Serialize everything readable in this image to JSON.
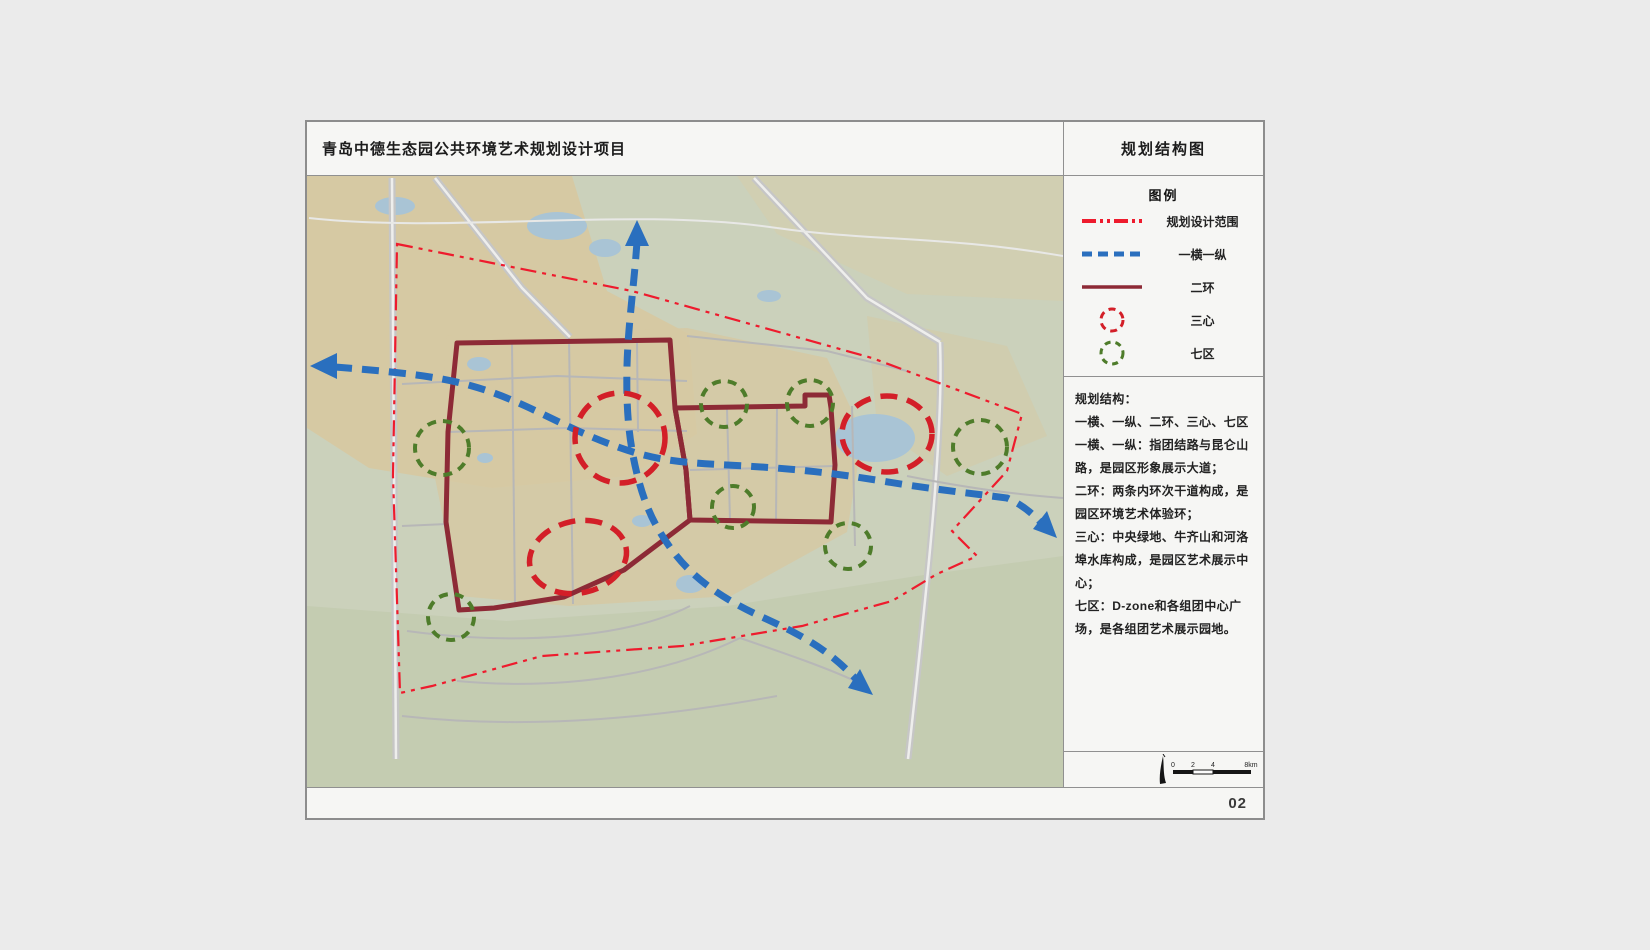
{
  "page": {
    "background": "#ebebeb",
    "page_number": "02"
  },
  "header": {
    "title": "青岛中德生态园公共环境艺术规划设计项目",
    "map_title": "规划结构图"
  },
  "legend": {
    "heading": "图例",
    "items": [
      {
        "label": "规划设计范围",
        "symbol": "red-dashdot-line",
        "color": "#ee1b2d"
      },
      {
        "label": "一横一纵",
        "symbol": "blue-dashed-line",
        "color": "#2a6fbe"
      },
      {
        "label": "二环",
        "symbol": "maroon-solid-line",
        "color": "#8d2a36"
      },
      {
        "label": "三心",
        "symbol": "red-dashed-circle",
        "color": "#d31f28"
      },
      {
        "label": "七区",
        "symbol": "green-dashed-circle",
        "color": "#4e7c2a"
      }
    ]
  },
  "description": {
    "lines": [
      "规划结构：",
      "一横、一纵、二环、三心、七区",
      "一横、一纵：指团结路与昆仑山路，是园区形象展示大道；",
      "二环：两条内环次干道构成，是园区环境艺术体验环；",
      "三心：中央绿地、牛齐山和河洛埠水库构成，是园区艺术展示中心；",
      "七区：D-zone和各组团中心广场，是各组团艺术展示园地。"
    ]
  },
  "scale_bar": {
    "ticks": [
      "0",
      "2",
      "4",
      "8km"
    ]
  },
  "map": {
    "colors": {
      "base_sage": "#cbd1bb",
      "beige": "#d6c9a3",
      "beige_light": "#d3cfae",
      "sage_dark": "#c3cbb0",
      "water": "#a9c4d5",
      "road_wide": "#c6c6c6",
      "road_core": "#eeeeec",
      "road_thin": "#b7b7b7",
      "road_white": "#e8e8e6",
      "boundary_red": "#ee1b2d",
      "route_blue": "#2a6fbe",
      "ring_maroon": "#8d2a36",
      "center_red": "#d31f28",
      "district_green": "#4e7c2a"
    }
  }
}
